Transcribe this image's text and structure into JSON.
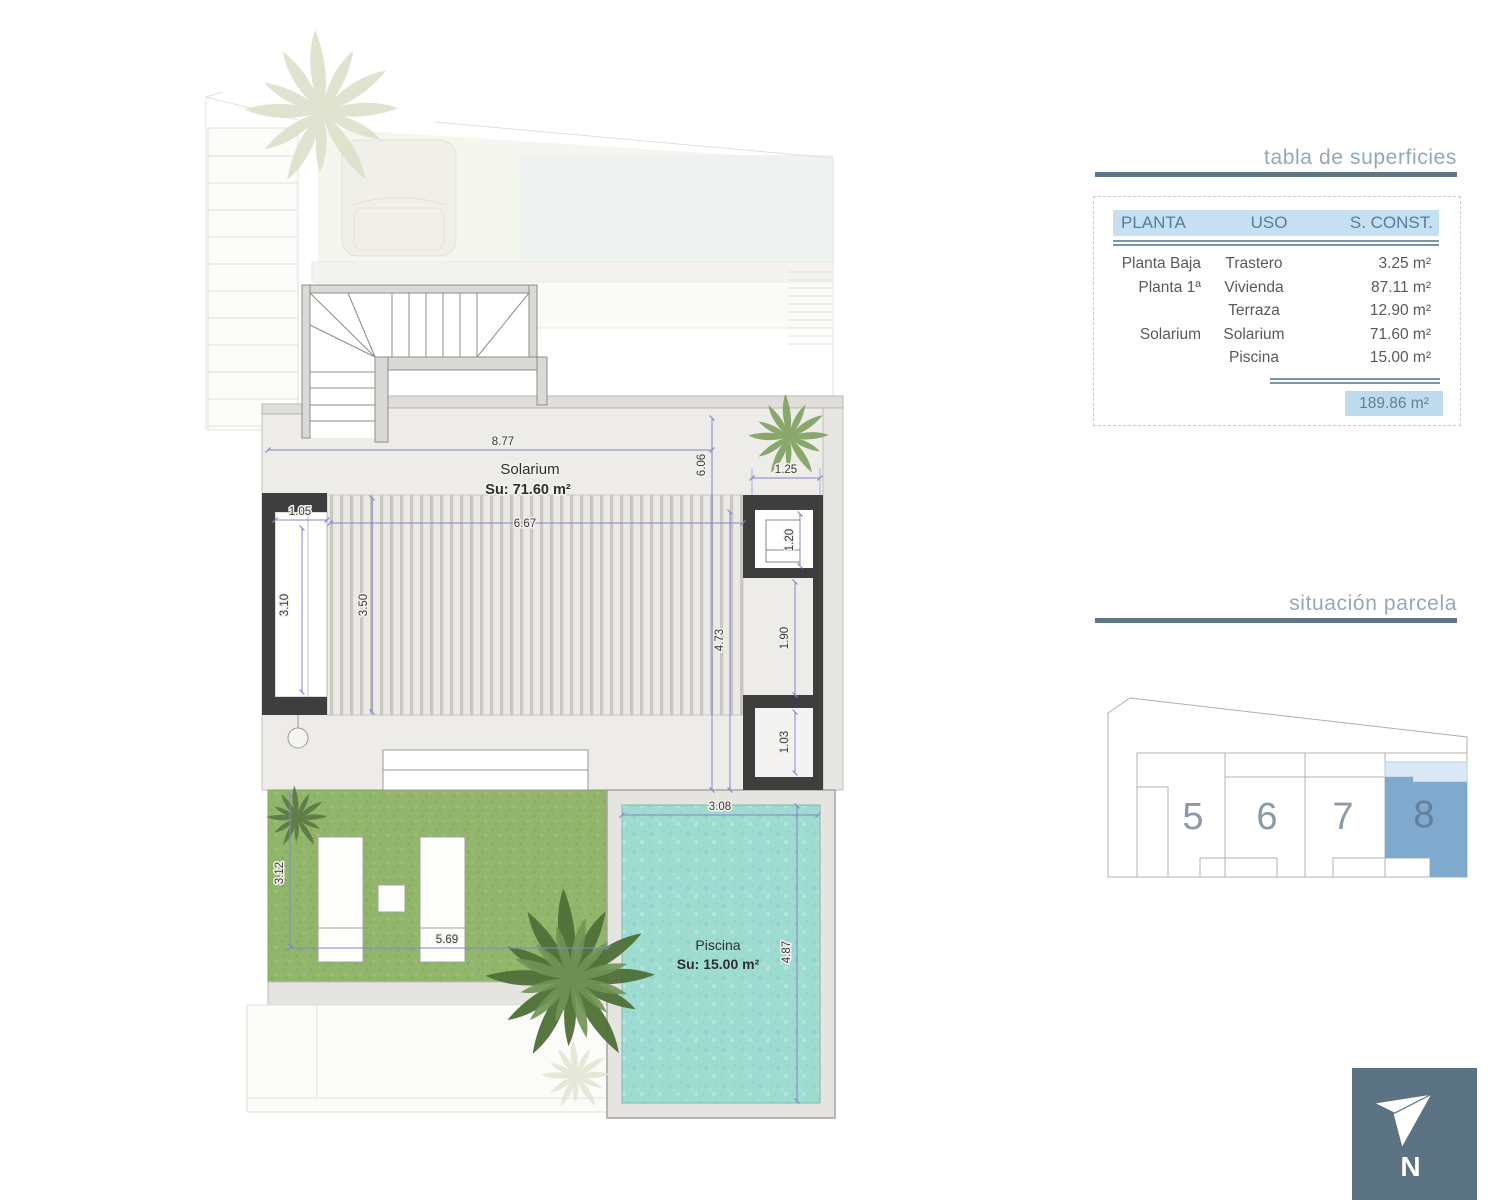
{
  "header": {
    "surface_table_title": "tabla de superficies",
    "parcel_title": "situación parcela"
  },
  "surface_table": {
    "col_planta": "PLANTA",
    "col_uso": "USO",
    "col_sconst": "S. CONST.",
    "rows": [
      {
        "planta": "Planta Baja",
        "uso": "Trastero",
        "sconst": "3.25 m²"
      },
      {
        "planta": "Planta 1ª",
        "uso": "Vivienda",
        "sconst": "87.11 m²"
      },
      {
        "planta": "",
        "uso": "Terraza",
        "sconst": "12.90 m²"
      },
      {
        "planta": "Solarium",
        "uso": "Solarium",
        "sconst": "71.60 m²"
      },
      {
        "planta": "",
        "uso": "Piscina",
        "sconst": "15.00 m²"
      }
    ],
    "total": "189.86 m²"
  },
  "plan": {
    "solarium_label": "Solarium",
    "solarium_area": "Su: 71.60 m²",
    "pool_label": "Piscina",
    "pool_area": "Su: 15.00 m²",
    "dims": {
      "d877": "8.77",
      "d606": "6.06",
      "d125": "1.25",
      "d667": "6.67",
      "d105": "1.05",
      "d310": "3.10",
      "d350": "3.50",
      "d473": "4.73",
      "d190": "1.90",
      "d120": "1.20",
      "d103": "1.03",
      "d308": "3.08",
      "d487": "4.87",
      "d312": "3.12",
      "d569": "5.69"
    }
  },
  "parcel_map": {
    "plot5": "5",
    "plot6": "6",
    "plot7": "7",
    "plot8": "8",
    "highlighted_plot": "8"
  },
  "compass": {
    "north_label": "N"
  },
  "colors": {
    "accent_slate": "#5e7686",
    "title_text": "#93a9b7",
    "table_header_bg": "#c7e0f1",
    "table_header_text": "#4f7ea3",
    "total_bg": "#bedaed",
    "highlight_dark": "#7fa9cd",
    "highlight_light": "#d9e8f4",
    "pool_water": "#9edbd1",
    "grass": "#90b56b",
    "wall_dark": "#3e3e3e",
    "dim_blue": "#8585cb",
    "north_box": "#5b7383"
  }
}
